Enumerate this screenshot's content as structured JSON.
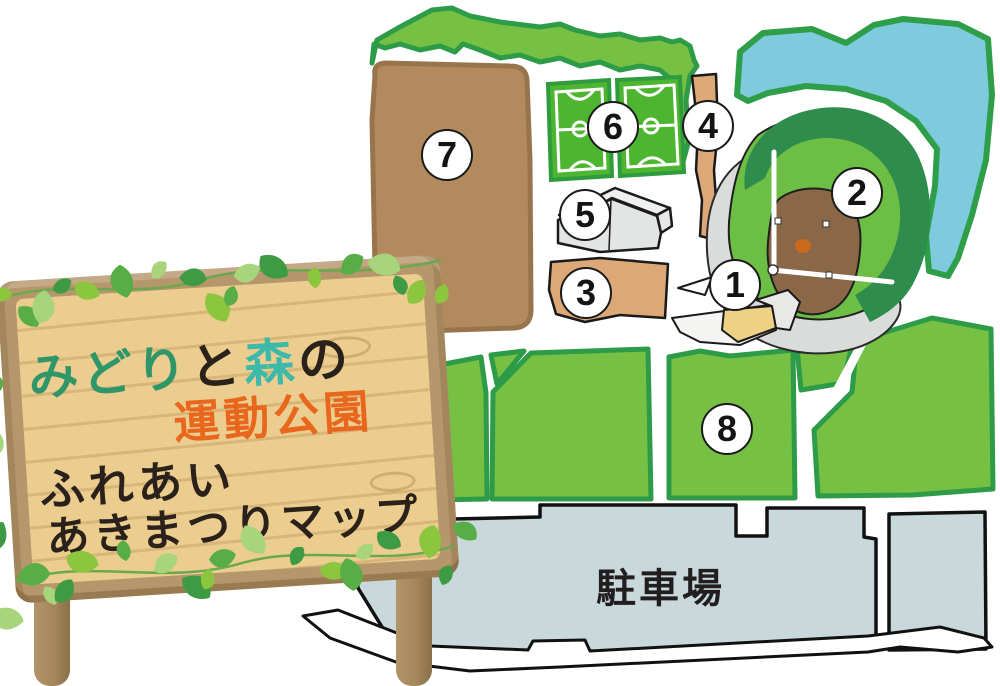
{
  "sign": {
    "title_segments": [
      {
        "text": "みどり",
        "color": "#2e9668"
      },
      {
        "text": "と",
        "color": "#2a211a"
      },
      {
        "text": "森",
        "color": "#3cb9a9"
      },
      {
        "text": "の",
        "color": "#2a211a"
      }
    ],
    "title_line2": {
      "text": "運動公園",
      "color": "#e8671d"
    },
    "subtitle_line1": "ふれあい",
    "subtitle_line2": "あきまつりマップ",
    "board_color": "#eccd90",
    "frame_color": "#b6976c",
    "post_color": "#a5875c",
    "leaf_colors": [
      "#8cc63f",
      "#58ad46",
      "#a8d47c",
      "#3f9b43"
    ]
  },
  "map": {
    "markers": [
      "1",
      "2",
      "3",
      "4",
      "5",
      "6",
      "7",
      "8"
    ],
    "parking_label": "駐車場",
    "colors": {
      "lawn": "#76c043",
      "lawn_border": "#2e9b48",
      "water": "#7ecbde",
      "water_border": "#2f9e49",
      "ground7": "#b28a5d",
      "ground7_border": "#97744c",
      "outfield": "#6cbe45",
      "infield": "#8a6847",
      "trees_dark": "#2e8c4d",
      "court": "#4db52f",
      "court_border": "#2f9b3f",
      "building_gray": "#e3e5e4",
      "tan_building": "#dca878",
      "parking": "#c9d9db",
      "stands_gray": "#dadbdb",
      "mound": "#c96a1e",
      "outline": "#1a1a1a",
      "road": "#ffffff"
    }
  }
}
